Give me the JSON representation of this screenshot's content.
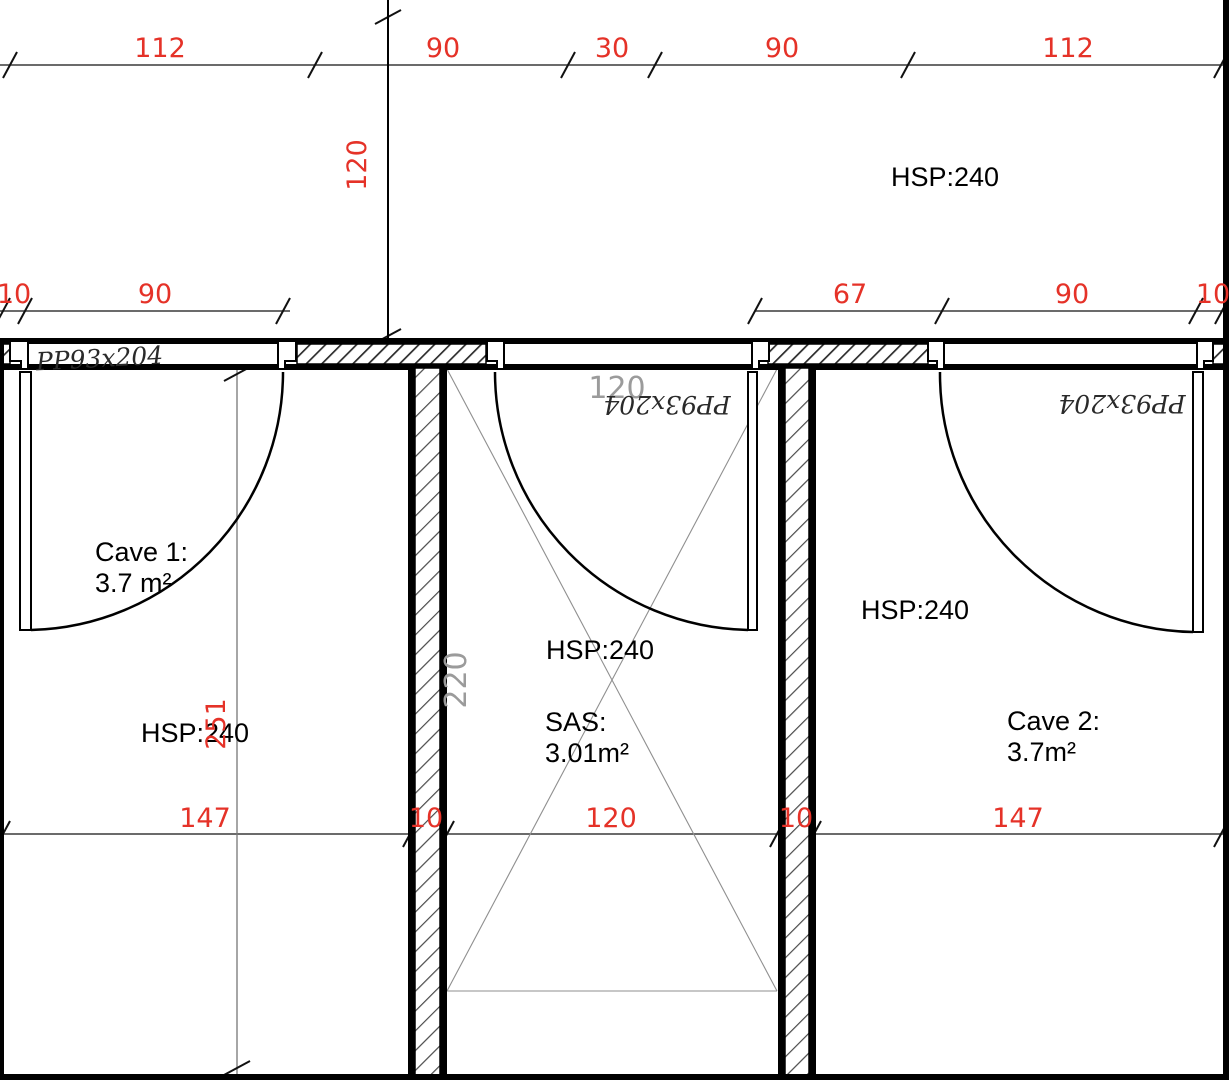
{
  "colors": {
    "dimension_red": "#e53228",
    "annotation_gray": "#9b9b9b",
    "wall_black": "#000000"
  },
  "dimensions": {
    "top_row": [
      "112",
      "90",
      "30",
      "90",
      "112"
    ],
    "top_vertical": "120",
    "left_mid_row": [
      "10",
      "90"
    ],
    "right_mid_row": [
      "67",
      "90",
      "10"
    ],
    "bottom_row": [
      "147",
      "10",
      "120",
      "10",
      "147"
    ],
    "cave1_vertical": "251",
    "sas_vertical": "220",
    "sas_width": "120"
  },
  "rooms": {
    "upper": {
      "height_label": "HSP:240"
    },
    "cave1": {
      "name": "Cave 1:",
      "area": "3.7 m²",
      "height_label": "HSP:240"
    },
    "sas": {
      "name": "SAS:",
      "area": "3.01m²",
      "height_label": "HSP:240"
    },
    "cave2": {
      "name": "Cave 2:",
      "area": "3.7m²",
      "height_label": "HSP:240"
    }
  },
  "doors": {
    "cave1_label": "PP93x204",
    "sas_label": "PP93x204",
    "cave2_label": "PP93x204"
  }
}
